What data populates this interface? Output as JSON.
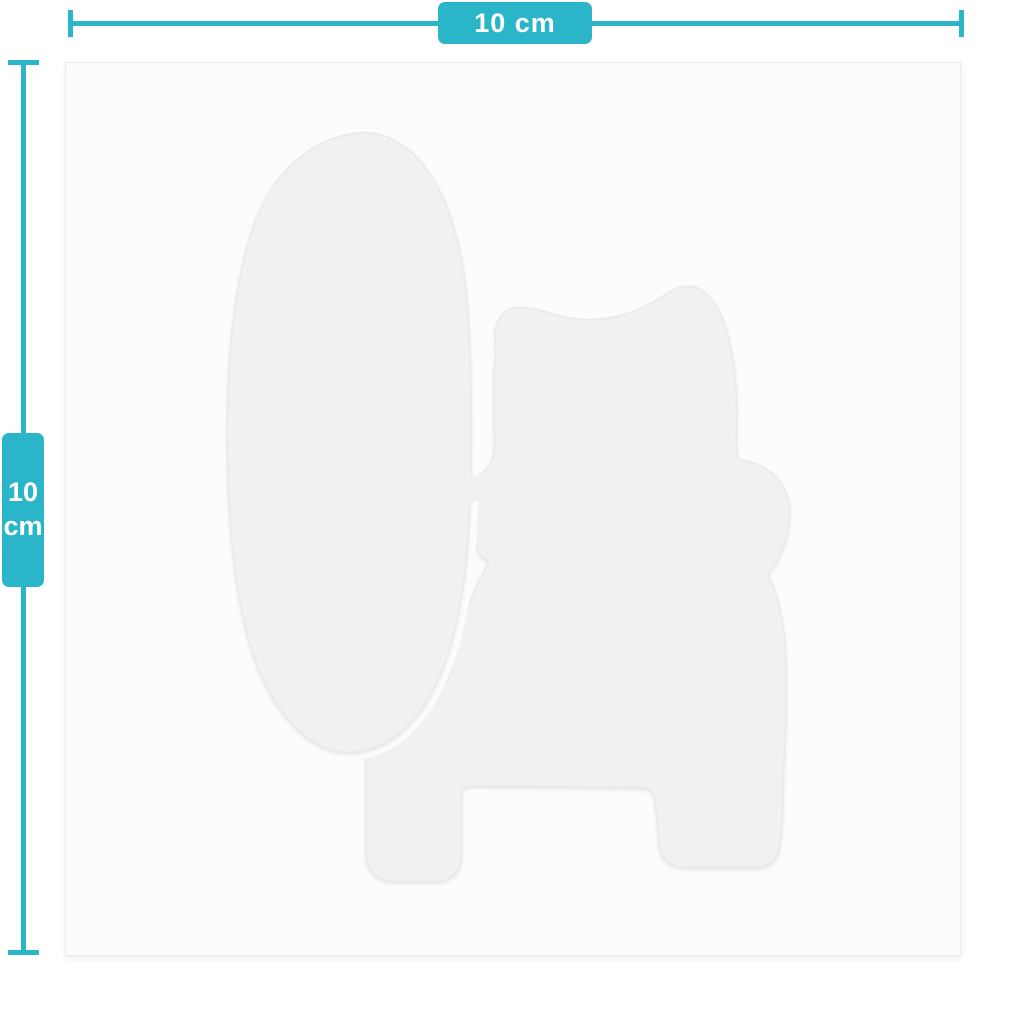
{
  "diagram": {
    "type": "product-dimension-diagram",
    "accent_color": "#2bb5c8",
    "rulers": {
      "horizontal": {
        "label": "10 cm"
      },
      "vertical": {
        "value": "10",
        "unit": "cm"
      }
    },
    "canvas": {
      "background": "#fcfcfc",
      "border_color": "#e9ebeb"
    },
    "sticker": {
      "description": "faint die-cut silhouette of a sitting lucky-cat (maneki-neko) holding a large upright oval sign",
      "fill": "#f0f1f1",
      "outline": "#e8eaea",
      "gap_color": "#fcfcfc"
    }
  }
}
